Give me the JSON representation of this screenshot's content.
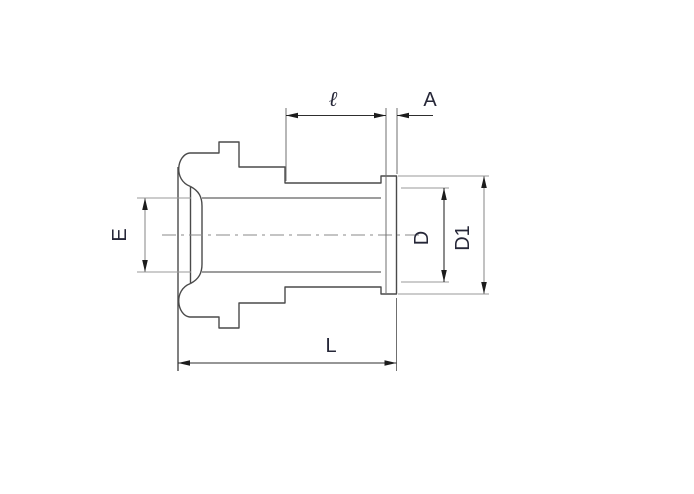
{
  "drawing": {
    "kind": "technical-dimension-drawing",
    "part": "tube-fitting-side-view",
    "colors": {
      "background": "#ffffff",
      "outline": "#4a4a4a",
      "light_line": "#8f8f8f",
      "dimension_line": "#2e2e2e",
      "label_text": "#262738"
    },
    "dims": {
      "tube_length": {
        "label": "ℓ"
      },
      "end_thickness": {
        "label": "A"
      },
      "left_diameter": {
        "label": "E"
      },
      "bore_diameter": {
        "label": "D"
      },
      "flange_diameter": {
        "label": "D1"
      },
      "overall_length": {
        "label": "L"
      }
    }
  }
}
